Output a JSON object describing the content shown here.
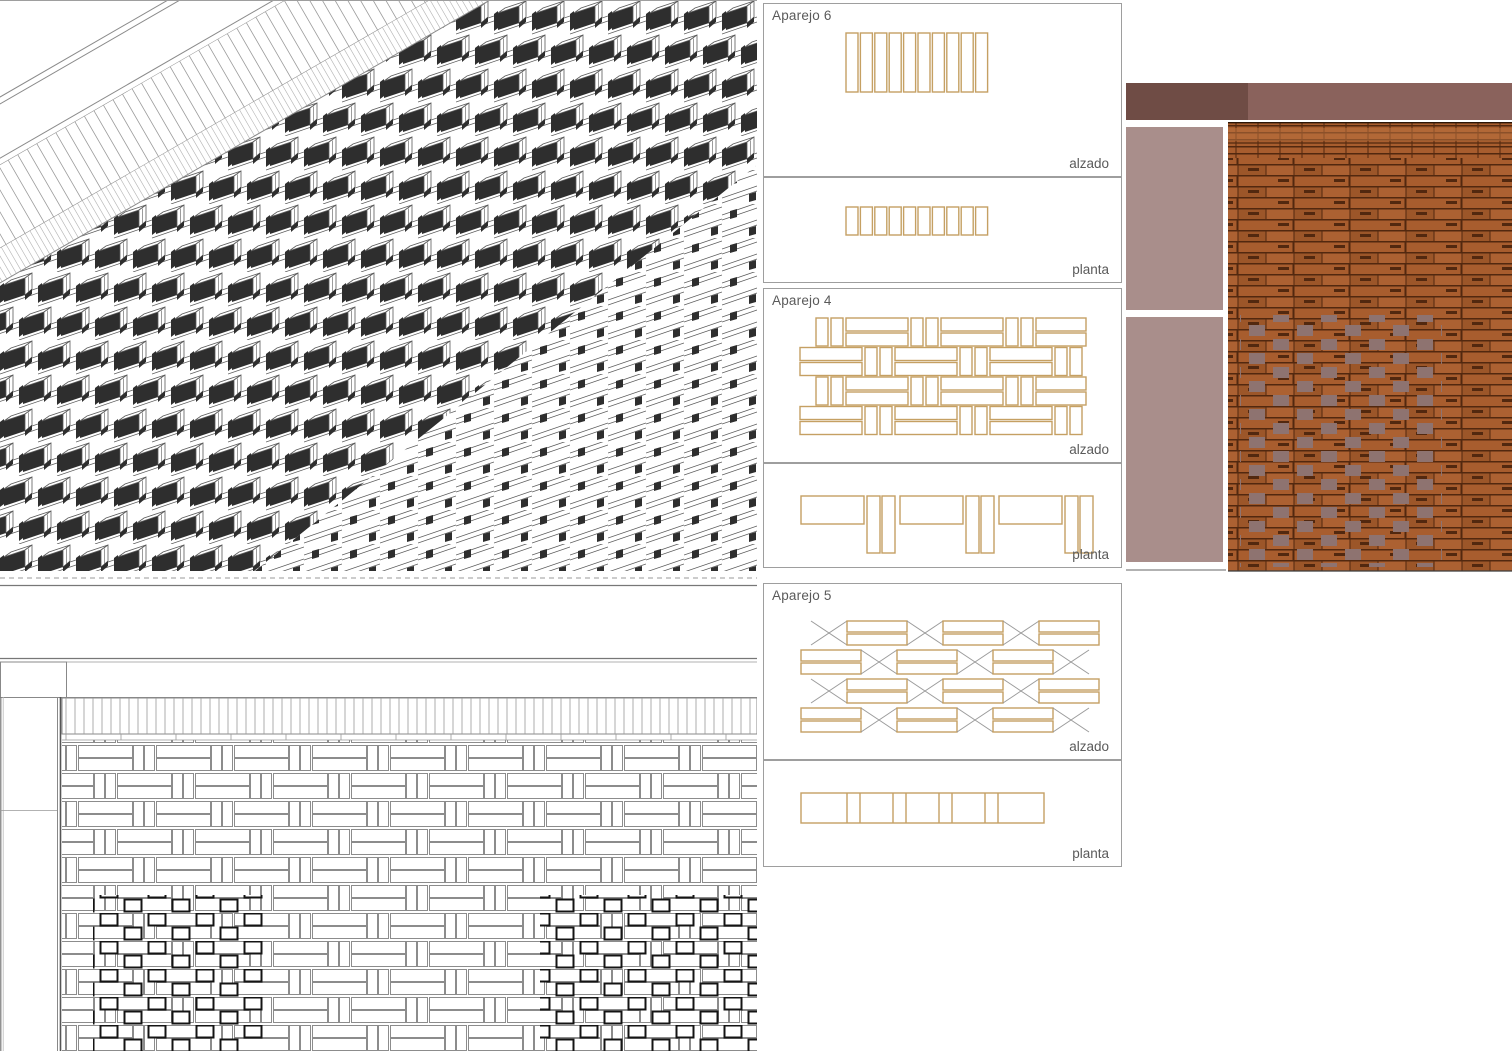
{
  "sheet": {
    "name": "brick-bond-drawing-sheet"
  },
  "panels": [
    {
      "id": "aparejo6",
      "title": "Aparejo 6",
      "views": [
        {
          "label": "alzado"
        },
        {
          "label": "planta"
        }
      ]
    },
    {
      "id": "aparejo4",
      "title": "Aparejo 4",
      "views": [
        {
          "label": "alzado"
        },
        {
          "label": "planta"
        }
      ]
    },
    {
      "id": "aparejo5",
      "title": "Aparejo 5",
      "views": [
        {
          "label": "alzado"
        },
        {
          "label": "planta"
        }
      ]
    }
  ],
  "colors": {
    "brick_outline": "#C5A063",
    "panel_border": "#9E9E9E",
    "label_text": "#5A5A5A",
    "drawing_line": "#8C8C8C",
    "cross_line": "#9B9B9B",
    "bold_square_line": "#141414",
    "axon_dark_face": "#2E2E2E",
    "axon_line": "#5A5A5A",
    "render_band_dark": "#6F4C45",
    "render_band_light": "#8A625C",
    "render_pink": "#A98E8B",
    "render_brick": "#A85D2E",
    "render_brick_light": "#B97140",
    "render_joint": "#52280F",
    "render_mauve_patch": "#8E7370"
  }
}
